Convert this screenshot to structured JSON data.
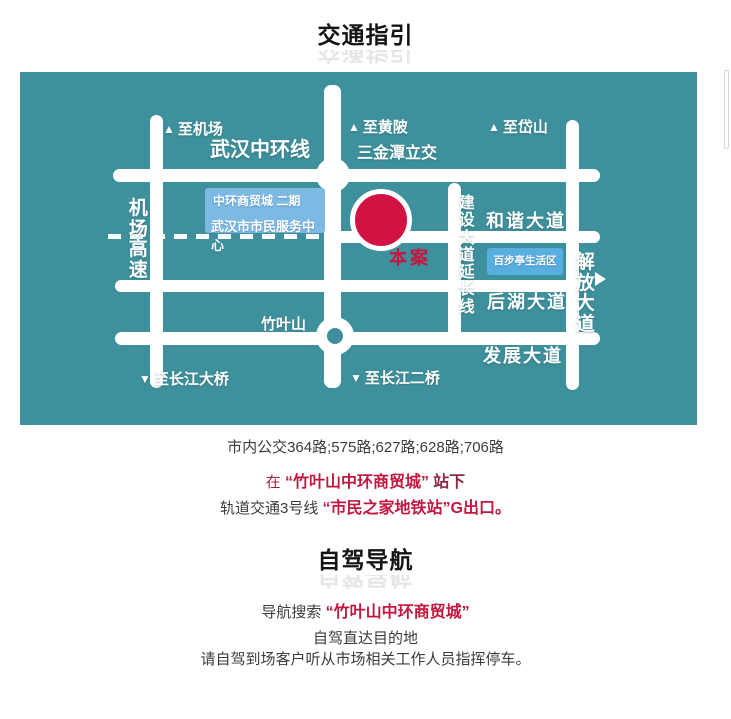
{
  "header": {
    "title": "交通指引"
  },
  "map": {
    "bg_color": "#3e919c",
    "site_marker_color": "#d21243",
    "arrow_up": "▲",
    "arrow_down": "▼",
    "label_to_airport": "至机场",
    "label_to_huangpi": "至黄陂",
    "label_to_daishan": "至岱山",
    "label_ring_road": "武汉中环线",
    "label_interchange": "三金潭立交",
    "label_airport_expressway": "机场高速",
    "market_box": {
      "line1": "中环商贸城 二期",
      "line2": "武汉市市民服务中心"
    },
    "label_site": "本案",
    "label_jianshe_ext": "建设大道延长线",
    "label_hexie_ave": "和谐大道",
    "label_baibuting": "百步亭生活区",
    "label_jiefang_ave": "解放大道",
    "label_houhu_ave": "后湖大道",
    "label_fazhan_ave": "发展大道",
    "label_zhuyeshan": "竹叶山",
    "label_to_yangtze_bridge": "至长江大桥",
    "label_to_yangtze_bridge2": "至长江二桥"
  },
  "transit": {
    "bus_line": "市内公交364路;575路;627路;628路;706路",
    "stop_line": {
      "prefix": "在",
      "highlight": "“竹叶山中环商贸城”",
      "suffix": "站下"
    },
    "metro_line": {
      "prefix": "轨道交通3号线",
      "highlight": "“市民之家地铁站”",
      "suffix": "G出口。"
    }
  },
  "driving": {
    "title": "自驾导航",
    "search_line": {
      "prefix": "导航搜索",
      "highlight": "“竹叶山中环商贸城”"
    },
    "line2": "自驾直达目的地",
    "line3": "请自驾到场客户听从市场相关工作人员指挥停车。"
  }
}
